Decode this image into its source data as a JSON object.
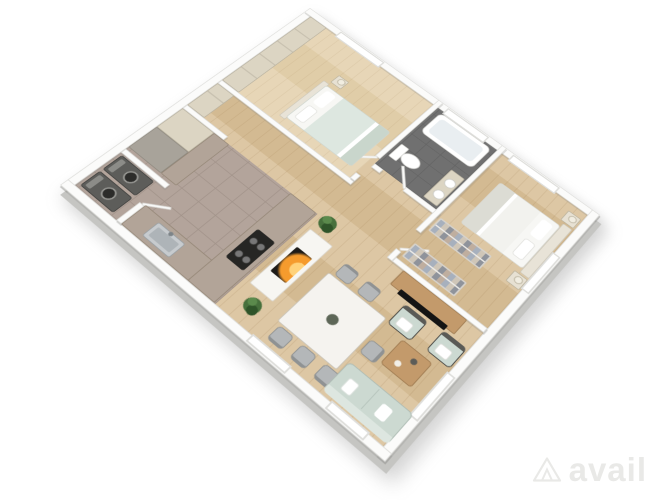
{
  "scene": {
    "type": "3d-floorplan-render",
    "label": "3D apartment floor plan"
  },
  "watermark": {
    "brand": "avail"
  },
  "palette": {
    "bg": "#ffffff",
    "wall": "#fbfbfa",
    "wall-edge": "#dededb",
    "wall-shade": "#c5c5c2",
    "wood": "#ddc7a4",
    "wood-dark": "#d3ba92",
    "wood-light": "#e7d6b7",
    "wood-light2": "#e0cda8",
    "tile": "#b3a49b",
    "tile-line": "#a2938a",
    "bath-floor": "#707070",
    "bath-line": "#646464",
    "counter": "#b2a498",
    "cabinet": "#dcd5c3",
    "cabinet-dark": "#a8a39a",
    "cabinet-seam": "#c8c1b0",
    "appliance": "#5d5d5a",
    "steel": "#c7cbce",
    "cooktop": "#262624",
    "sofa": "#ccd9d1",
    "sofa-light": "#dde6e0",
    "chair": "#b4b7b9",
    "chair-dark": "#8f9293",
    "table-top": "#f5f3ef",
    "wood-furn": "#c39a6b",
    "tv-black": "#141414",
    "fire-core": "#ffd27a",
    "fire-mid": "#f59b2d",
    "firebox": "#1d1b18",
    "plant": "#47703c",
    "plant-hi": "#5b8a4c",
    "plant-dark": "#2f5429",
    "bed1-duvet": "#dde7e0",
    "bed1-throw": "#c9d6cc",
    "bed2-duvet": "#f2f2ee",
    "bed2-blanket": "#dcdcd4",
    "headboard": "#e8e3d7",
    "pillow": "#ffffff",
    "nightstand": "#e7e1d3",
    "tub-inner": "#e9eef1",
    "rack-a": "#a7b0bd",
    "rack-b": "#cfc6b8",
    "rack-c": "#8f939b",
    "rack-d": "#bfae9f",
    "watermark": "#e9e9e7"
  },
  "rooms": [
    "laundry-closet",
    "kitchen",
    "hallway",
    "living-room",
    "dining-area",
    "bedroom-1",
    "bathroom",
    "walk-in-closet",
    "bedroom-2"
  ],
  "furniture": [
    "washer",
    "dryer",
    "kitchen-sink",
    "cooktop",
    "tall-cabinets",
    "refrigerator",
    "fireplace",
    "potted-plants",
    "dining-table",
    "dining-chairs",
    "sofa",
    "coffee-table",
    "armchairs",
    "tv-console",
    "tv",
    "bed-sage-bedding",
    "bed-white-bedding",
    "nightstands",
    "toilet",
    "bathtub",
    "vanity-double-sink",
    "clothes-racks",
    "wardrobes"
  ]
}
